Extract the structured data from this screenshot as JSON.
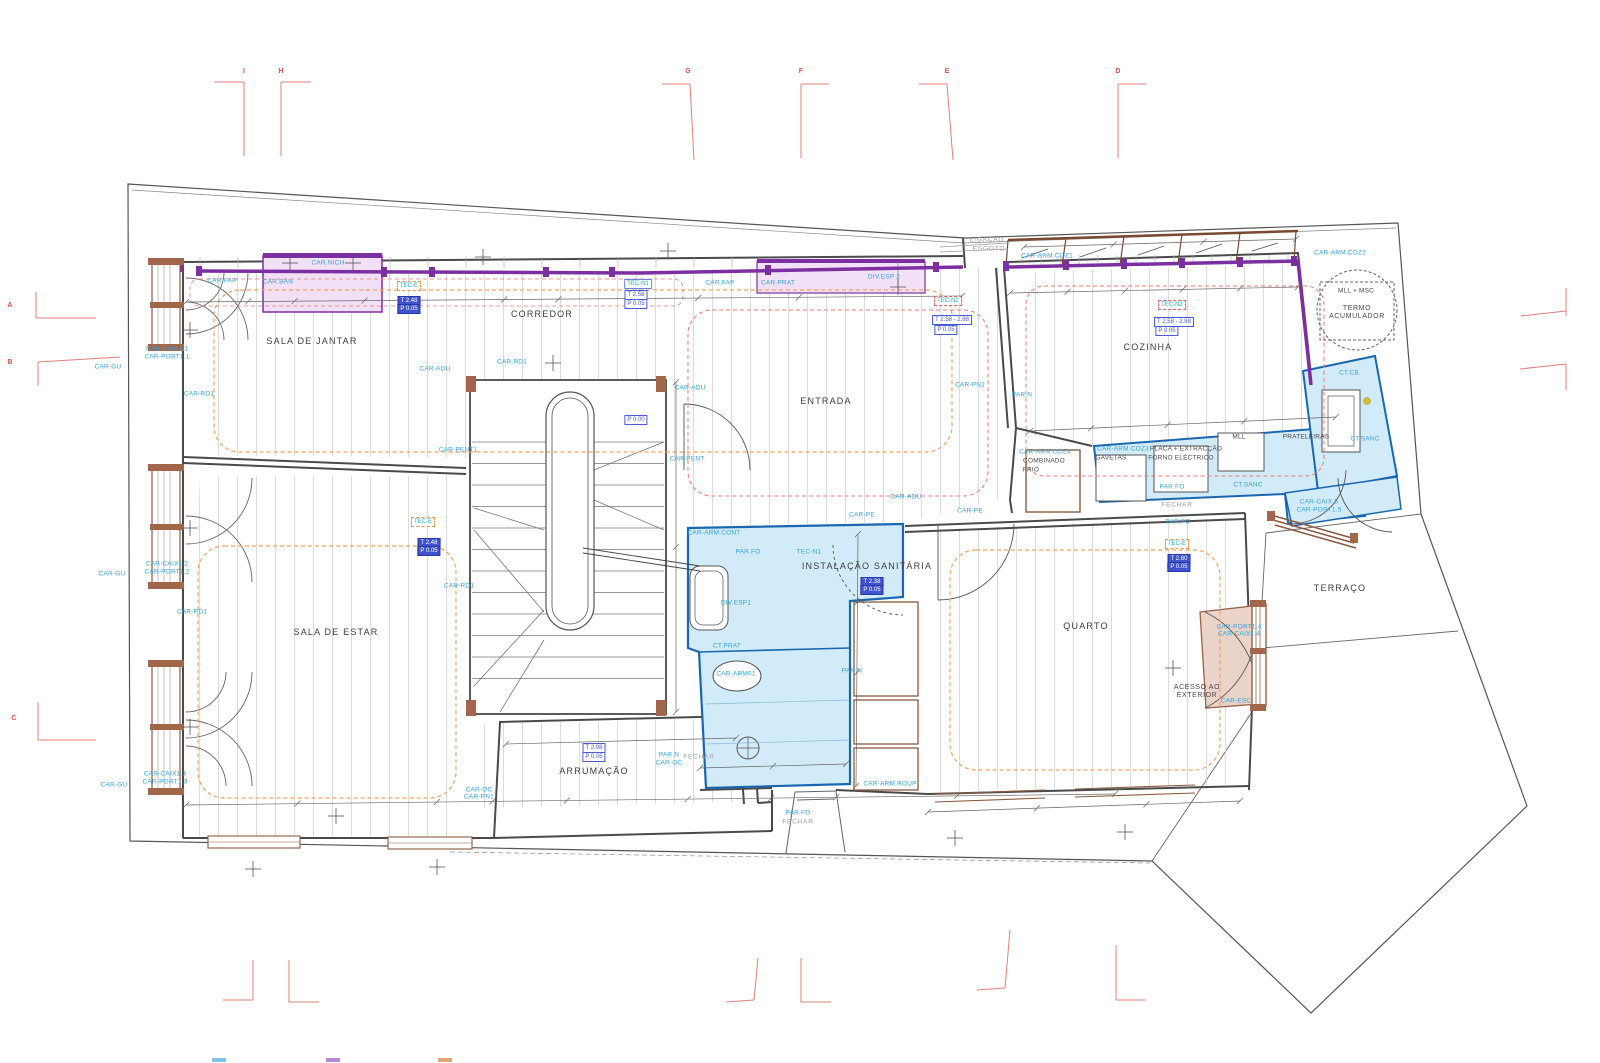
{
  "title": "architectural-floor-plan",
  "colors": {
    "purple_band": "#7b2fa0",
    "pink_fill": "#f2e0f7",
    "blue_zone_fill": "#d2ebf8",
    "blue_zone_stroke": "#1a67b0",
    "cyan_label": "#35a3dc",
    "orange_ceiling": "#f2a35f",
    "red_ceiling": "#e87b72",
    "grid_red": "#e08078",
    "wood_brown": "#8a5a40"
  },
  "grid": {
    "top": [
      {
        "label": "I",
        "x": 244,
        "y": 72
      },
      {
        "label": "H",
        "x": 281,
        "y": 72
      },
      {
        "label": "G",
        "x": 688,
        "y": 72
      },
      {
        "label": "F",
        "x": 801,
        "y": 72
      },
      {
        "label": "E",
        "x": 947,
        "y": 72
      },
      {
        "label": "D",
        "x": 1118,
        "y": 72
      }
    ],
    "left": [
      {
        "label": "A",
        "x": 10,
        "y": 306
      },
      {
        "label": "B",
        "x": 10,
        "y": 363
      },
      {
        "label": "C",
        "x": 14,
        "y": 719
      }
    ]
  },
  "labels": [
    {
      "t": "SALA DE JANTAR",
      "x": 312,
      "y": 341,
      "k": "room"
    },
    {
      "t": "CORREDOR",
      "x": 542,
      "y": 314,
      "k": "room"
    },
    {
      "t": "ENTRADA",
      "x": 826,
      "y": 401,
      "k": "room"
    },
    {
      "t": "COZINHA",
      "x": 1148,
      "y": 347,
      "k": "room"
    },
    {
      "t": "SALA DE ESTAR",
      "x": 336,
      "y": 632,
      "k": "room"
    },
    {
      "t": "INSTALAÇÃO SANITÁRIA",
      "x": 867,
      "y": 566,
      "k": "room"
    },
    {
      "t": "QUARTO",
      "x": 1086,
      "y": 626,
      "k": "room"
    },
    {
      "t": "ARRUMAÇÃO",
      "x": 594,
      "y": 771,
      "k": "room"
    },
    {
      "t": "TERRAÇO",
      "x": 1340,
      "y": 588,
      "k": "room"
    },
    {
      "t": "ACESSO AO\nEXTERIOR",
      "x": 1197,
      "y": 692,
      "k": "rs"
    },
    {
      "t": "TERMO\nACUMULADOR",
      "x": 1357,
      "y": 313,
      "k": "rs"
    },
    {
      "t": "MLL + MSC",
      "x": 1356,
      "y": 291,
      "k": "ds"
    },
    {
      "t": "CAR.FAP",
      "x": 222,
      "y": 281,
      "k": "c"
    },
    {
      "t": "CAR.BAN",
      "x": 278,
      "y": 282,
      "k": "c"
    },
    {
      "t": "CAR.NICH",
      "x": 328,
      "y": 263,
      "k": "c"
    },
    {
      "t": "CAR-CAIX1.1",
      "x": 167,
      "y": 349,
      "k": "c"
    },
    {
      "t": "CAR-PORT1.1",
      "x": 167,
      "y": 357,
      "k": "c"
    },
    {
      "t": "CAR-GU",
      "x": 108,
      "y": 367,
      "k": "c"
    },
    {
      "t": "CAR-RD1",
      "x": 199,
      "y": 394,
      "k": "c"
    },
    {
      "t": "CAR-ADU",
      "x": 435,
      "y": 369,
      "k": "c"
    },
    {
      "t": "CAR.RD1",
      "x": 512,
      "y": 362,
      "k": "c"
    },
    {
      "t": "CAR-PENT1",
      "x": 458,
      "y": 450,
      "k": "c"
    },
    {
      "t": "CAR-ADU",
      "x": 690,
      "y": 388,
      "k": "c"
    },
    {
      "t": "CAR-PENT",
      "x": 687,
      "y": 459,
      "k": "c"
    },
    {
      "t": "CAR.FAP",
      "x": 720,
      "y": 283,
      "k": "c"
    },
    {
      "t": "CAR.PRAT",
      "x": 778,
      "y": 283,
      "k": "c"
    },
    {
      "t": "DIV.ESP 2",
      "x": 884,
      "y": 277,
      "k": "c"
    },
    {
      "t": "CAR-PN2",
      "x": 970,
      "y": 385,
      "k": "c"
    },
    {
      "t": "PAR.N",
      "x": 1022,
      "y": 395,
      "k": "c"
    },
    {
      "t": "CAR-ARM.COZ1",
      "x": 1047,
      "y": 256,
      "k": "c"
    },
    {
      "t": "CAR-ARM.COZ2",
      "x": 1340,
      "y": 253,
      "k": "c"
    },
    {
      "t": "CT.CB.",
      "x": 1350,
      "y": 373,
      "k": "c"
    },
    {
      "t": "CT.SANC",
      "x": 1365,
      "y": 439,
      "k": "c"
    },
    {
      "t": "CAR-ARM.COZ4",
      "x": 1045,
      "y": 452,
      "k": "c"
    },
    {
      "t": "COMBINADO",
      "x": 1044,
      "y": 461,
      "k": "ds"
    },
    {
      "t": "FRIO",
      "x": 1031,
      "y": 470,
      "k": "ds"
    },
    {
      "t": "CAR-ARM.COZ3",
      "x": 1123,
      "y": 449,
      "k": "c"
    },
    {
      "t": "GAVETAS",
      "x": 1111,
      "y": 458,
      "k": "ds"
    },
    {
      "t": "PLACA + EXTRACÇÃO",
      "x": 1186,
      "y": 449,
      "k": "ds"
    },
    {
      "t": "FORNO ELÉCTRICO",
      "x": 1181,
      "y": 458,
      "k": "ds"
    },
    {
      "t": "MLL",
      "x": 1239,
      "y": 437,
      "k": "ds"
    },
    {
      "t": "PRATELEIRAS",
      "x": 1306,
      "y": 437,
      "k": "ds"
    },
    {
      "t": "PAR.FO",
      "x": 1172,
      "y": 487,
      "k": "c"
    },
    {
      "t": "CT.SANC",
      "x": 1248,
      "y": 485,
      "k": "c"
    },
    {
      "t": "FECHAR",
      "x": 1177,
      "y": 505,
      "k": "g"
    },
    {
      "t": "PAR.FO",
      "x": 1178,
      "y": 522,
      "k": "c"
    },
    {
      "t": "CAR-CAIX.5",
      "x": 1319,
      "y": 502,
      "k": "c"
    },
    {
      "t": "CAR-PORT1.5",
      "x": 1319,
      "y": 510,
      "k": "c"
    },
    {
      "t": "CAR-ADU",
      "x": 906,
      "y": 497,
      "k": "c"
    },
    {
      "t": "CAR-PE",
      "x": 862,
      "y": 515,
      "k": "c"
    },
    {
      "t": "CAR-PE",
      "x": 970,
      "y": 511,
      "k": "c"
    },
    {
      "t": "CAR-ARM.CONT",
      "x": 714,
      "y": 533,
      "k": "c"
    },
    {
      "t": "PAR.FO",
      "x": 748,
      "y": 552,
      "k": "c"
    },
    {
      "t": "TEC-N1",
      "x": 809,
      "y": 552,
      "k": "c"
    },
    {
      "t": "DIV.ESP1",
      "x": 736,
      "y": 603,
      "k": "c"
    },
    {
      "t": "CT.PRAT",
      "x": 727,
      "y": 646,
      "k": "c"
    },
    {
      "t": "CAR-ARM01",
      "x": 736,
      "y": 674,
      "k": "c"
    },
    {
      "t": "PAR.N",
      "x": 852,
      "y": 671,
      "k": "c"
    },
    {
      "t": "CAR-PORT1.4",
      "x": 1239,
      "y": 627,
      "k": "c"
    },
    {
      "t": "CAR-CAIX1.4",
      "x": 1239,
      "y": 634,
      "k": "c"
    },
    {
      "t": "CAR-ESC",
      "x": 1236,
      "y": 701,
      "k": "c"
    },
    {
      "t": "CAR-RD1",
      "x": 459,
      "y": 586,
      "k": "c"
    },
    {
      "t": "CAR-RD1",
      "x": 192,
      "y": 612,
      "k": "c"
    },
    {
      "t": "CAR-CAIX1.2",
      "x": 167,
      "y": 564,
      "k": "c"
    },
    {
      "t": "CAR-PORT1.2",
      "x": 167,
      "y": 572,
      "k": "c"
    },
    {
      "t": "CAR-GU",
      "x": 112,
      "y": 574,
      "k": "c"
    },
    {
      "t": "CAR-GU",
      "x": 114,
      "y": 785,
      "k": "c"
    },
    {
      "t": "CAR-CAIX1.3",
      "x": 165,
      "y": 774,
      "k": "c"
    },
    {
      "t": "CAR-PORT1.3",
      "x": 165,
      "y": 782,
      "k": "c"
    },
    {
      "t": "CAR-OC",
      "x": 479,
      "y": 790,
      "k": "c"
    },
    {
      "t": "CAR-PN1",
      "x": 479,
      "y": 797,
      "k": "c"
    },
    {
      "t": "PAR.N",
      "x": 669,
      "y": 755,
      "k": "c"
    },
    {
      "t": "CAR-OC",
      "x": 669,
      "y": 763,
      "k": "c"
    },
    {
      "t": "FECHAR",
      "x": 699,
      "y": 757,
      "k": "g"
    },
    {
      "t": "CAR-ARM.ROUP",
      "x": 890,
      "y": 784,
      "k": "c"
    },
    {
      "t": "PAR.FO",
      "x": 798,
      "y": 813,
      "k": "c"
    },
    {
      "t": "FECHAR",
      "x": 798,
      "y": 822,
      "k": "g"
    },
    {
      "t": "LIGAÇÃO",
      "x": 987,
      "y": 240,
      "k": "g"
    },
    {
      "t": "ESGOTO",
      "x": 989,
      "y": 249,
      "k": "g"
    }
  ],
  "boxes": [
    {
      "t": "TEC-E",
      "x": 409,
      "y": 286,
      "k": "tec"
    },
    {
      "t": "T 2.48",
      "x": 409,
      "y": 301,
      "k": "fill"
    },
    {
      "t": "P 0.05",
      "x": 409,
      "y": 309,
      "k": "fill"
    },
    {
      "t": "TEC-N1",
      "x": 638,
      "y": 284,
      "k": "n1"
    },
    {
      "t": "T 2.58",
      "x": 636,
      "y": 295,
      "k": "out"
    },
    {
      "t": "P 0.05",
      "x": 636,
      "y": 304,
      "k": "out"
    },
    {
      "t": "TEC-N2",
      "x": 948,
      "y": 301,
      "k": "n2"
    },
    {
      "t": "T 2.58 - 2.88",
      "x": 952,
      "y": 320,
      "k": "out"
    },
    {
      "t": "P 0.05",
      "x": 946,
      "y": 330,
      "k": "out"
    },
    {
      "t": "TEC-N2",
      "x": 1172,
      "y": 305,
      "k": "n2"
    },
    {
      "t": "T 2.58 - 2.88",
      "x": 1174,
      "y": 322,
      "k": "out"
    },
    {
      "t": "P 0.05",
      "x": 1167,
      "y": 331,
      "k": "out"
    },
    {
      "t": "P 0.00",
      "x": 636,
      "y": 420,
      "k": "out"
    },
    {
      "t": "T 2.38",
      "x": 872,
      "y": 582,
      "k": "fill"
    },
    {
      "t": "P 0.05",
      "x": 872,
      "y": 590,
      "k": "fill"
    },
    {
      "t": "TEC-E",
      "x": 423,
      "y": 522,
      "k": "tec"
    },
    {
      "t": "T 2.48",
      "x": 429,
      "y": 543,
      "k": "fill"
    },
    {
      "t": "P 0.05",
      "x": 429,
      "y": 551,
      "k": "fill"
    },
    {
      "t": "TEC-E",
      "x": 1177,
      "y": 544,
      "k": "tec"
    },
    {
      "t": "T 2.60",
      "x": 1179,
      "y": 559,
      "k": "fill"
    },
    {
      "t": "P 0.05",
      "x": 1179,
      "y": 567,
      "k": "fill"
    },
    {
      "t": "T 2.98",
      "x": 594,
      "y": 748,
      "k": "out"
    },
    {
      "t": "P 0.05",
      "x": 594,
      "y": 757,
      "k": "out"
    }
  ],
  "legend": {
    "swatches": [
      {
        "x": 212,
        "y": 1058,
        "color": "#7fc4e8"
      },
      {
        "x": 326,
        "y": 1058,
        "color": "#b58ad4"
      },
      {
        "x": 438,
        "y": 1058,
        "color": "#e0a878"
      }
    ]
  }
}
